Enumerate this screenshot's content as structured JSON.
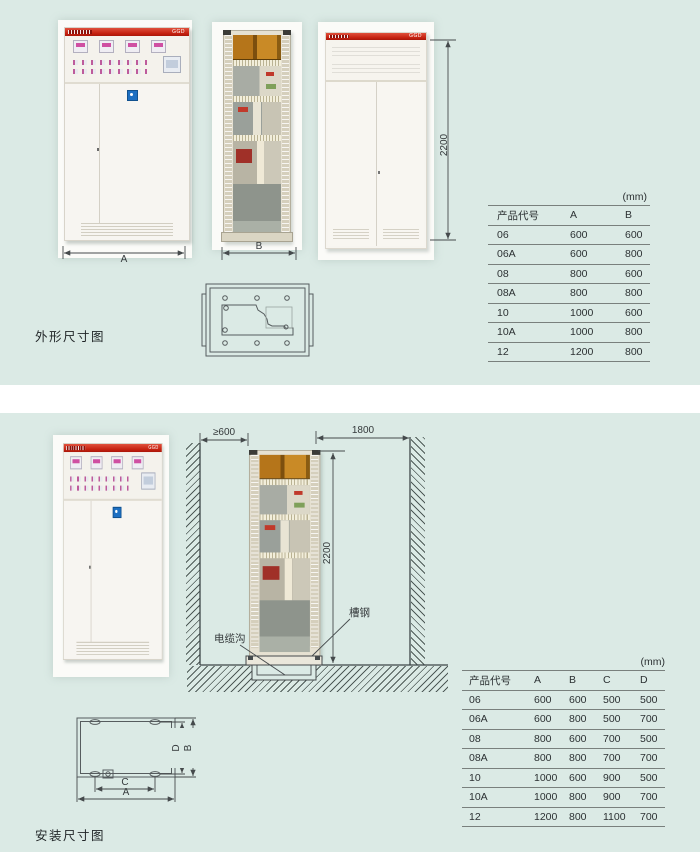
{
  "cabinet": {
    "model": "GGD"
  },
  "colors": {
    "background": "#dbeae5",
    "accent_red": "#c4200f",
    "line": "#454a4c"
  },
  "sections": {
    "outline": {
      "title": "外形尺寸图",
      "dims": {
        "width": "A",
        "depth": "B",
        "height": "2200"
      },
      "table": {
        "unit": "(mm)",
        "columns": [
          "产品代号",
          "A",
          "B"
        ],
        "rows": [
          [
            "06",
            "600",
            "600"
          ],
          [
            "06A",
            "600",
            "800"
          ],
          [
            "08",
            "800",
            "600"
          ],
          [
            "08A",
            "800",
            "800"
          ],
          [
            "10",
            "1000",
            "600"
          ],
          [
            "10A",
            "1000",
            "800"
          ],
          [
            "12",
            "1200",
            "800"
          ]
        ]
      }
    },
    "install": {
      "title": "安装尺寸图",
      "dims": {
        "left_clearance": "≥600",
        "rear_clearance": "1800",
        "height": "2200",
        "plan_a": "A",
        "plan_b": "B",
        "plan_c": "C",
        "plan_d": "D"
      },
      "labels": {
        "channel_steel": "槽钢",
        "cable_trench": "电缆沟"
      },
      "table": {
        "unit": "(mm)",
        "columns": [
          "产品代号",
          "A",
          "B",
          "C",
          "D"
        ],
        "rows": [
          [
            "06",
            "600",
            "600",
            "500",
            "500"
          ],
          [
            "06A",
            "600",
            "800",
            "500",
            "700"
          ],
          [
            "08",
            "800",
            "600",
            "700",
            "500"
          ],
          [
            "08A",
            "800",
            "800",
            "700",
            "700"
          ],
          [
            "10",
            "1000",
            "600",
            "900",
            "500"
          ],
          [
            "10A",
            "1000",
            "800",
            "900",
            "700"
          ],
          [
            "12",
            "1200",
            "800",
            "1100",
            "700"
          ]
        ]
      }
    }
  }
}
